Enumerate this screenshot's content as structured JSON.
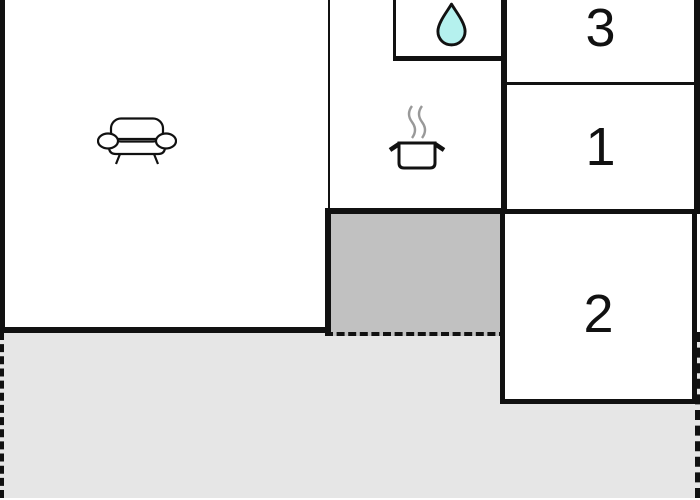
{
  "floorplan": {
    "rooms": {
      "living": {
        "name": "living-room",
        "icon": "sofa-icon"
      },
      "kitchen": {
        "name": "kitchen",
        "icon": "cooking-pot-icon"
      },
      "bathroom": {
        "name": "bathroom",
        "icon": "water-drop-icon"
      },
      "room3": {
        "label": "3"
      },
      "room1": {
        "label": "1"
      },
      "room2": {
        "label": "2"
      }
    },
    "areas": {
      "inner_courtyard": {
        "fill": "#c1c1c1"
      },
      "terrace": {
        "fill": "#e6e6e6"
      }
    },
    "colors": {
      "wall": "#111111",
      "room_fill": "#ffffff",
      "water_drop": "#b5f1ee",
      "steam": "#999999",
      "label": "#111111"
    }
  }
}
